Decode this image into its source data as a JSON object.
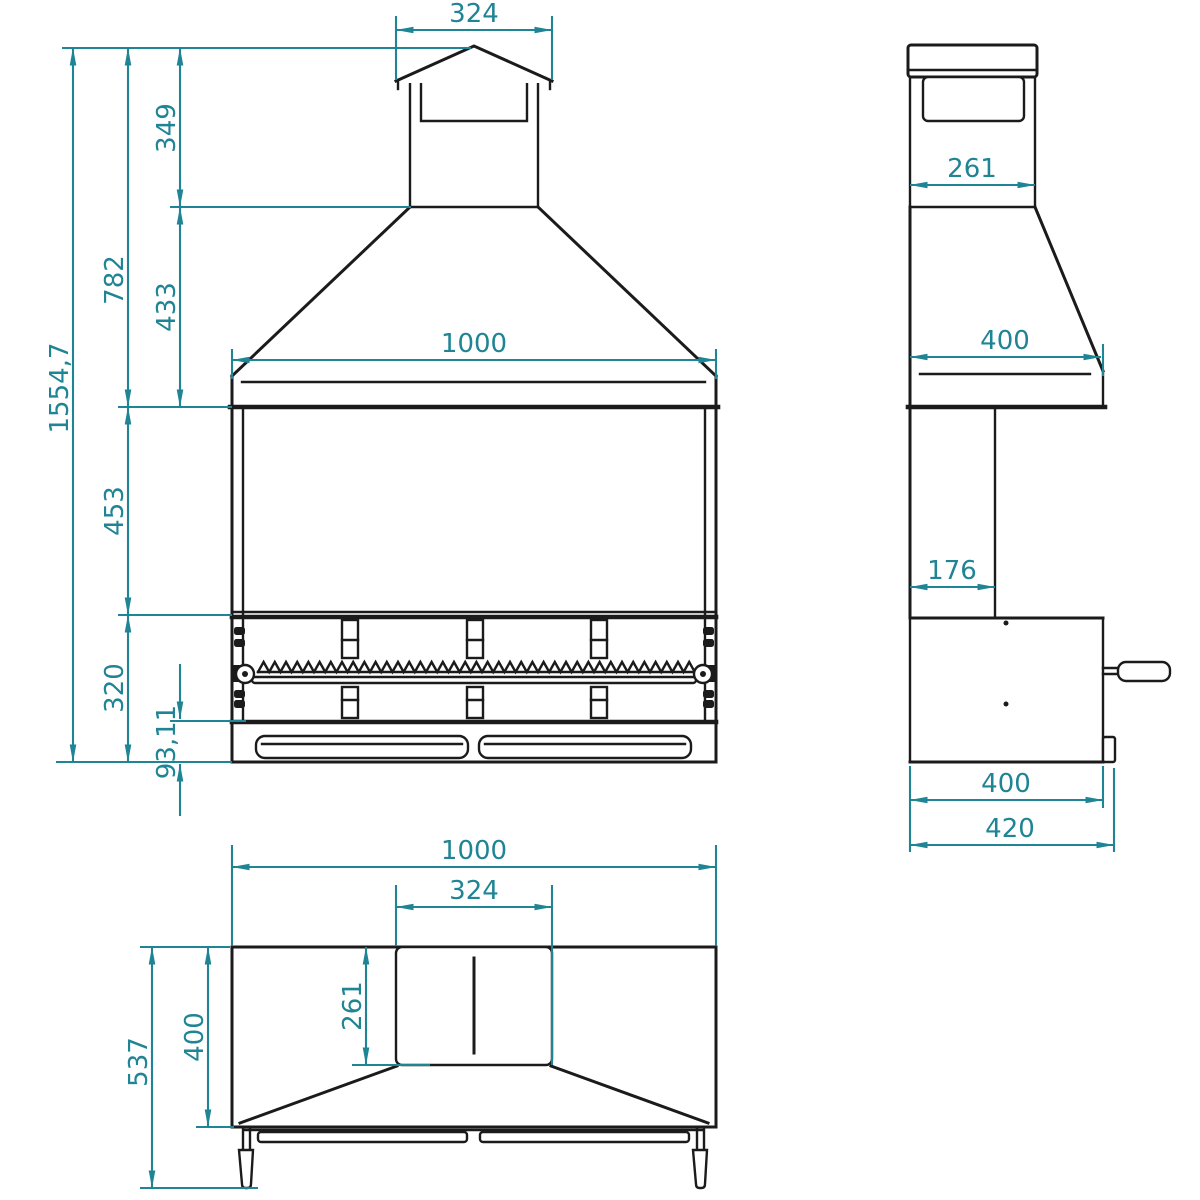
{
  "colors": {
    "dimension": "#1f8494",
    "line": "#1b1b1b",
    "background": "#ffffff"
  },
  "views": {
    "front": {
      "dims": {
        "cap_width": "324",
        "cap_height": "349",
        "cap_and_hood_height": "782",
        "total_height": "1554,7",
        "hood_height": "433",
        "width": "1000",
        "chamber_height": "453",
        "grill_section_height": "320",
        "drawer_front_height": "93,11"
      }
    },
    "side": {
      "dims": {
        "duct_depth": "261",
        "hood_depth": "400",
        "back_column_depth": "176",
        "firebox_depth": "400",
        "total_depth": "420"
      }
    },
    "top": {
      "dims": {
        "width": "1000",
        "chimney_cap_width": "324",
        "chimney_cap_depth": "261",
        "hood_depth": "400",
        "total_depth": "537"
      }
    }
  }
}
